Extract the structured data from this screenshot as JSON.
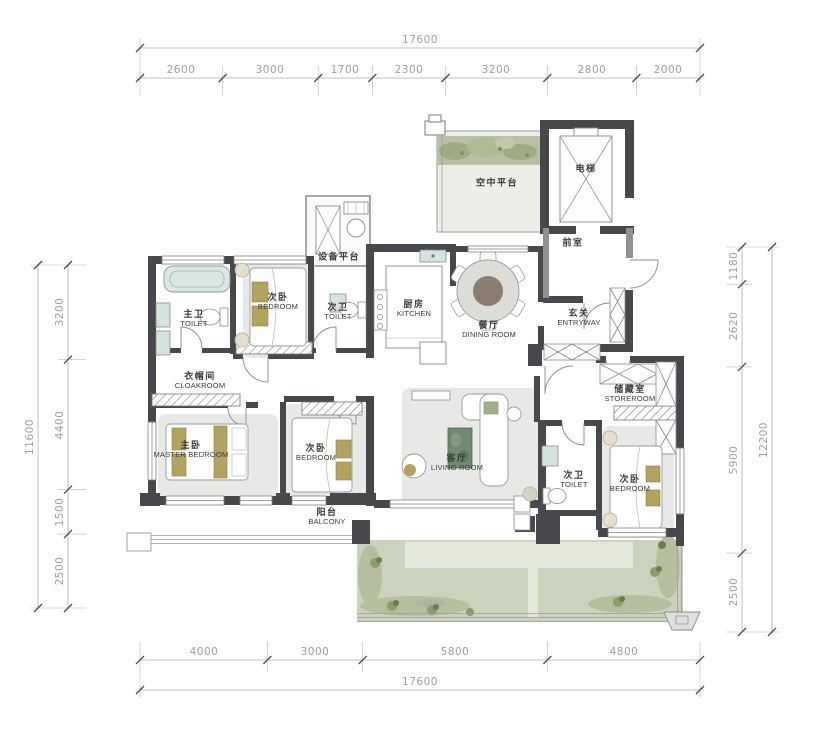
{
  "dims": {
    "top": {
      "total": "17600",
      "segments": [
        "2600",
        "3000",
        "1700",
        "2300",
        "3200",
        "2800",
        "2000"
      ]
    },
    "bottom": {
      "total": "17600",
      "segments": [
        "4000",
        "3000",
        "5800",
        "4800"
      ]
    },
    "left": {
      "total": "11600",
      "segments": [
        "3200",
        "4400",
        "1500",
        "2500"
      ]
    },
    "right": {
      "total": "12200",
      "segments": [
        "1180",
        "2620",
        "5900",
        "2500"
      ]
    }
  },
  "rooms": {
    "sky_platform": {
      "zh": "空中平台",
      "en": ""
    },
    "elevator": {
      "zh": "电梯",
      "en": ""
    },
    "lobby": {
      "zh": "前室",
      "en": ""
    },
    "equipment_platform": {
      "zh": "设备平台",
      "en": ""
    },
    "master_toilet": {
      "zh": "主卫",
      "en": "TOILET"
    },
    "bedroom_top": {
      "zh": "次卧",
      "en": "BEDROOM"
    },
    "toilet_top": {
      "zh": "次卫",
      "en": "TOILET"
    },
    "kitchen": {
      "zh": "厨房",
      "en": "KITCHEN"
    },
    "dining": {
      "zh": "餐厅",
      "en": "DINING ROOM"
    },
    "entryway": {
      "zh": "玄关",
      "en": "ENTRYWAY"
    },
    "cloakroom": {
      "zh": "衣帽间",
      "en": "CLOAKROOM"
    },
    "master_bedroom": {
      "zh": "主卧",
      "en": "MASTER BEDROOM"
    },
    "bedroom_left": {
      "zh": "次卧",
      "en": "BEDROOM"
    },
    "living": {
      "zh": "客厅",
      "en": "LIVING ROOM"
    },
    "storeroom": {
      "zh": "储藏室",
      "en": "STOREROOM"
    },
    "toilet_right": {
      "zh": "次卫",
      "en": "TOILET"
    },
    "bedroom_right": {
      "zh": "次卧",
      "en": "BEDROOM"
    },
    "balcony": {
      "zh": "阳台",
      "en": "BALCONY"
    }
  },
  "colors": {
    "wall": "#47484c",
    "wall_medium": "#8f9196",
    "dimension_text": "#9f9f9f",
    "label_text": "#3b3b3b",
    "garden": "#ccd3bc",
    "garden_shade": "#b5bf9e",
    "plant": "#72855a",
    "rug": "#e8e8e6",
    "furniture_accent": "#b3a35f",
    "fixture_teal": "#d5e3df",
    "dining_table_top": "#8b7d6e",
    "coffee_table": "#6f8a70",
    "platform_green": "#b9c0a6"
  }
}
